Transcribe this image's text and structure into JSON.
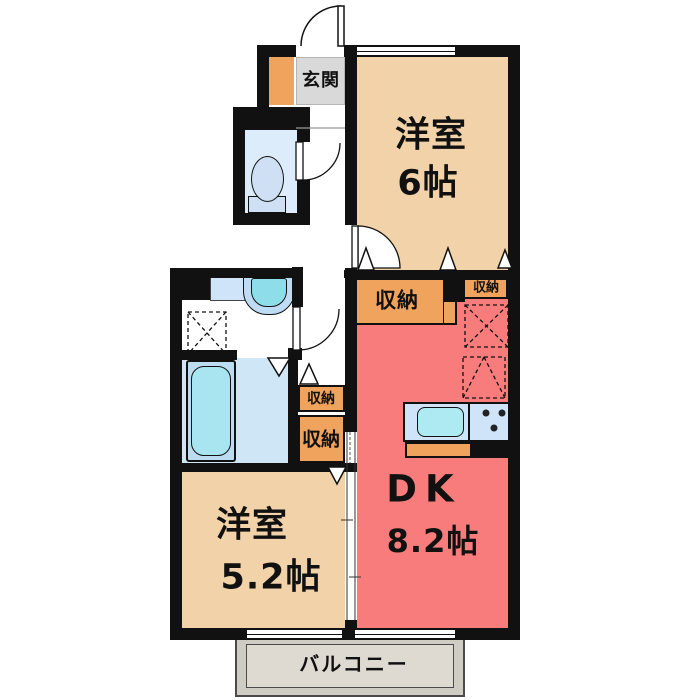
{
  "plan": {
    "entrance_label": "玄関",
    "balcony_label": "バルコニー",
    "room_west_6": {
      "title": "洋室",
      "size": "6帖"
    },
    "room_west_52": {
      "title": "洋室",
      "size": "5.2帖"
    },
    "room_dk": {
      "title": "DK",
      "size": "8.2帖"
    },
    "storage_top_large": "収納",
    "storage_top_small": "収納",
    "storage_mid_upper": "収納",
    "storage_mid_lower": "収納"
  },
  "colors": {
    "room_tan": "#f2d2a8",
    "room_red": "#f87c7c",
    "storage_orange": "#efa35c",
    "entrance_gray": "#d9d9d9",
    "bathroom_blue": "#cfe6f6",
    "bathtub_cyan": "#a9e5f1",
    "counter_blue": "#cfe4f8",
    "sink_cyan": "#8edeea",
    "toilet_blue": "#cfe0f5",
    "balcony_gray": "#dcd8d0",
    "wall_black": "#111111"
  }
}
